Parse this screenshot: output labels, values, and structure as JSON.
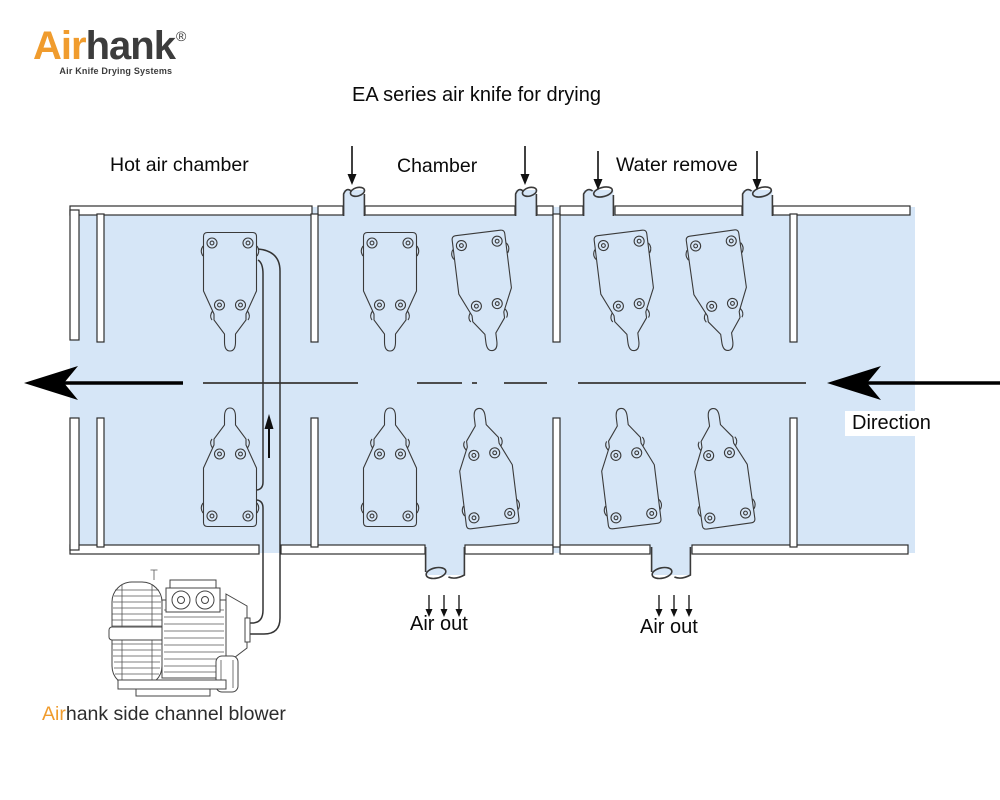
{
  "logo": {
    "brand_prefix": "Air",
    "brand_suffix": "hank",
    "registered_mark": "®",
    "tagline": "Air Knife Drying Systems"
  },
  "title": "EA series air knife for drying",
  "section_labels": {
    "hot_air_chamber": "Hot air chamber",
    "chamber": "Chamber",
    "water_remove": "Water remove"
  },
  "flow_labels": {
    "direction": "Direction",
    "air_out_left": "Air out",
    "air_out_right": "Air out"
  },
  "caption": {
    "brand_prefix": "Air",
    "rest": "hank side channel blower"
  },
  "colors": {
    "chamber_fill": "#d6e6f7",
    "wall_fill": "#ffffff",
    "diagram_outline": "#2e2e2e",
    "product_line": "#4d4d4d",
    "brand_orange": "#f09c2e",
    "brand_dark": "#3c3c3c",
    "text": "#0a0a0a"
  }
}
